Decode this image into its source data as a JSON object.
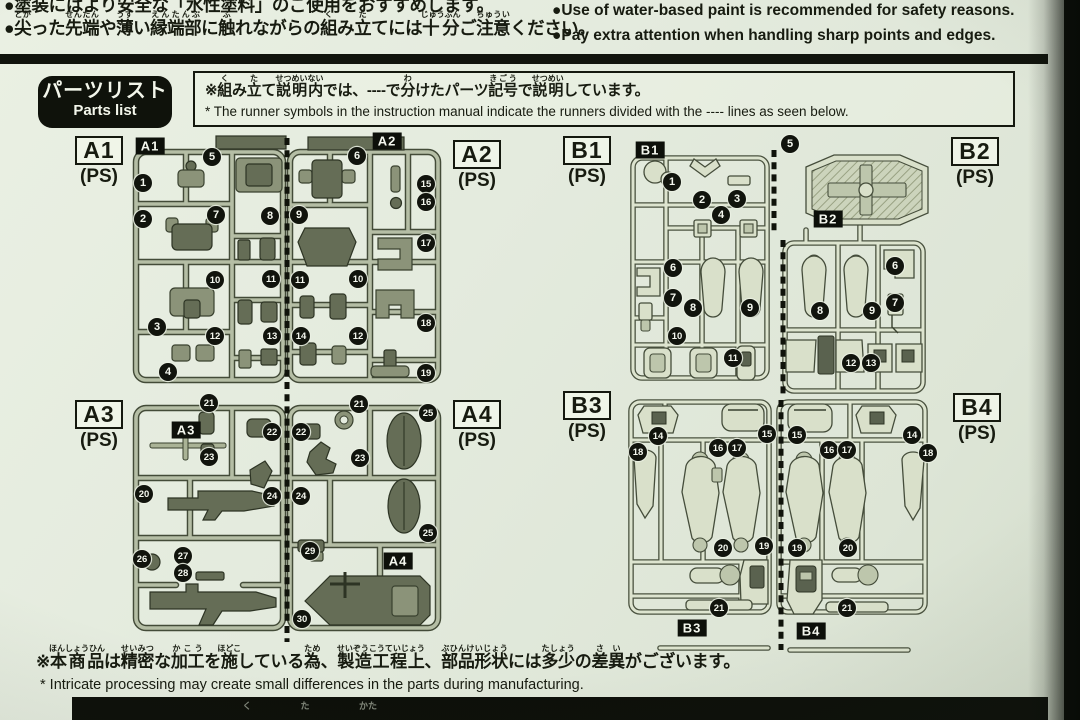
{
  "safety_notes": {
    "jp1": "●塗装にはより安全な「水性塗料」のご使用をおすすめします。",
    "jp2": [
      [
        "●"
      ],
      [
        "尖",
        "とが"
      ],
      [
        "った"
      ],
      [
        "先端",
        "せんたん"
      ],
      [
        "や"
      ],
      [
        "薄",
        "うす"
      ],
      [
        "い"
      ],
      [
        "縁端部",
        "えんたんぶ"
      ],
      [
        "に"
      ],
      [
        "触",
        "ふ"
      ],
      [
        "れながらの"
      ],
      [
        "組",
        "く"
      ],
      [
        "み"
      ],
      [
        "立",
        "た"
      ],
      [
        "てには"
      ],
      [
        "十分",
        "じゅうぶん"
      ],
      [
        "ご"
      ],
      [
        "注意",
        "ちゅうい"
      ],
      [
        "ください。"
      ]
    ],
    "en1": "●Use of water-based paint is recommended for safety reasons.",
    "en2": "●Pay extra attention when handling sharp points and edges."
  },
  "parts_list": {
    "title_jp": "パーツリスト",
    "title_en": "Parts list"
  },
  "runner_note": {
    "jp": [
      [
        "※"
      ],
      [
        "組",
        "く"
      ],
      [
        "み"
      ],
      [
        "立",
        "た"
      ],
      [
        "て"
      ],
      [
        "説明内",
        "せつめいない"
      ],
      [
        "では、----で"
      ],
      [
        "分",
        "わ"
      ],
      [
        "けたパーツ"
      ],
      [
        "記号",
        "きごう"
      ],
      [
        "で"
      ],
      [
        "説明",
        "せつめい"
      ],
      [
        "しています。"
      ]
    ],
    "en": "* The runner symbols in the instruction manual indicate the runners divided with the ---- lines as seen below."
  },
  "bottom_note": {
    "jp": [
      [
        "※"
      ],
      [
        "本商品",
        "ほんしょうひん"
      ],
      [
        "は"
      ],
      [
        "精密",
        "せいみつ"
      ],
      [
        "な"
      ],
      [
        "加工",
        "かこう"
      ],
      [
        "を"
      ],
      [
        "施",
        "ほどこ"
      ],
      [
        "している"
      ],
      [
        "為",
        "ため"
      ],
      [
        "、"
      ],
      [
        "製造工程上",
        "せいぞうこうていじょう"
      ],
      [
        "、"
      ],
      [
        "部品形状",
        "ぶひんけいじょう"
      ],
      [
        "には"
      ],
      [
        "多少",
        "たしょう"
      ],
      [
        "の"
      ],
      [
        "差異",
        "さい"
      ],
      [
        "がございます。"
      ]
    ],
    "en": "* Intricate processing may create small differences in the parts during manufacturing."
  },
  "next_section": {
    "furigana": [
      {
        "t": "く",
        "x": 247
      },
      {
        "t": "た",
        "x": 305
      },
      {
        "t": "かた",
        "x": 368
      }
    ]
  },
  "colors": {
    "page": "#e4ebde",
    "ink": "#171b10",
    "black": "#0d100a"
  },
  "runners": [
    {
      "code": "A1",
      "material": "(PS)",
      "label": {
        "x": 68,
        "y": 136
      },
      "tag": {
        "x": 150,
        "y": 146
      },
      "parts": [
        {
          "n": "1",
          "x": 143,
          "y": 183
        },
        {
          "n": "2",
          "x": 143,
          "y": 219
        },
        {
          "n": "5",
          "x": 212,
          "y": 157
        },
        {
          "n": "7",
          "x": 216,
          "y": 215
        },
        {
          "n": "8",
          "x": 270,
          "y": 216
        },
        {
          "n": "10",
          "x": 215,
          "y": 280
        },
        {
          "n": "11",
          "x": 271,
          "y": 279
        },
        {
          "n": "3",
          "x": 157,
          "y": 327
        },
        {
          "n": "12",
          "x": 215,
          "y": 336
        },
        {
          "n": "13",
          "x": 272,
          "y": 336
        },
        {
          "n": "4",
          "x": 168,
          "y": 372
        }
      ]
    },
    {
      "code": "A2",
      "material": "(PS)",
      "label": {
        "x": 446,
        "y": 140
      },
      "tag": {
        "x": 387,
        "y": 141
      },
      "parts": [
        {
          "n": "6",
          "x": 357,
          "y": 156
        },
        {
          "n": "9",
          "x": 299,
          "y": 215
        },
        {
          "n": "11",
          "x": 300,
          "y": 280
        },
        {
          "n": "10",
          "x": 358,
          "y": 279
        },
        {
          "n": "14",
          "x": 301,
          "y": 336
        },
        {
          "n": "12",
          "x": 358,
          "y": 336
        },
        {
          "n": "15",
          "x": 426,
          "y": 184
        },
        {
          "n": "16",
          "x": 426,
          "y": 202
        },
        {
          "n": "17",
          "x": 426,
          "y": 243
        },
        {
          "n": "18",
          "x": 426,
          "y": 323
        },
        {
          "n": "19",
          "x": 426,
          "y": 373
        }
      ]
    },
    {
      "code": "A3",
      "material": "(PS)",
      "label": {
        "x": 68,
        "y": 400
      },
      "tag": {
        "x": 186,
        "y": 430
      },
      "parts": [
        {
          "n": "21",
          "x": 209,
          "y": 403
        },
        {
          "n": "22",
          "x": 272,
          "y": 432
        },
        {
          "n": "23",
          "x": 209,
          "y": 457
        },
        {
          "n": "20",
          "x": 144,
          "y": 494
        },
        {
          "n": "24",
          "x": 272,
          "y": 496
        },
        {
          "n": "26",
          "x": 142,
          "y": 559
        },
        {
          "n": "27",
          "x": 183,
          "y": 556
        },
        {
          "n": "28",
          "x": 183,
          "y": 573
        }
      ]
    },
    {
      "code": "A4",
      "material": "(PS)",
      "label": {
        "x": 446,
        "y": 400
      },
      "tag": {
        "x": 398,
        "y": 561
      },
      "parts": [
        {
          "n": "22",
          "x": 301,
          "y": 432
        },
        {
          "n": "21",
          "x": 359,
          "y": 404
        },
        {
          "n": "23",
          "x": 360,
          "y": 458
        },
        {
          "n": "24",
          "x": 301,
          "y": 496
        },
        {
          "n": "25",
          "x": 428,
          "y": 413
        },
        {
          "n": "25",
          "x": 428,
          "y": 533
        },
        {
          "n": "29",
          "x": 310,
          "y": 551
        },
        {
          "n": "30",
          "x": 302,
          "y": 619
        }
      ]
    },
    {
      "code": "B1",
      "material": "(PS)",
      "label": {
        "x": 556,
        "y": 136
      },
      "tag": {
        "x": 650,
        "y": 150
      },
      "parts": [
        {
          "n": "1",
          "x": 672,
          "y": 182
        },
        {
          "n": "2",
          "x": 702,
          "y": 200
        },
        {
          "n": "3",
          "x": 737,
          "y": 199
        },
        {
          "n": "4",
          "x": 721,
          "y": 215
        },
        {
          "n": "6",
          "x": 673,
          "y": 268
        },
        {
          "n": "7",
          "x": 673,
          "y": 298
        },
        {
          "n": "8",
          "x": 693,
          "y": 308
        },
        {
          "n": "9",
          "x": 750,
          "y": 308
        },
        {
          "n": "10",
          "x": 677,
          "y": 336
        },
        {
          "n": "11",
          "x": 733,
          "y": 358
        }
      ]
    },
    {
      "code": "B2",
      "material": "(PS)",
      "label": {
        "x": 944,
        "y": 137
      },
      "tag": {
        "x": 828,
        "y": 219
      },
      "parts": [
        {
          "n": "5",
          "x": 790,
          "y": 144
        },
        {
          "n": "6",
          "x": 895,
          "y": 266
        },
        {
          "n": "7",
          "x": 895,
          "y": 303
        },
        {
          "n": "8",
          "x": 820,
          "y": 311
        },
        {
          "n": "9",
          "x": 872,
          "y": 311
        },
        {
          "n": "12",
          "x": 851,
          "y": 363
        },
        {
          "n": "13",
          "x": 871,
          "y": 363
        }
      ]
    },
    {
      "code": "B3",
      "material": "(PS)",
      "label": {
        "x": 556,
        "y": 391
      },
      "tag": {
        "x": 692,
        "y": 628
      },
      "parts": [
        {
          "n": "14",
          "x": 658,
          "y": 436
        },
        {
          "n": "15",
          "x": 767,
          "y": 434
        },
        {
          "n": "16",
          "x": 718,
          "y": 448
        },
        {
          "n": "17",
          "x": 737,
          "y": 448
        },
        {
          "n": "18",
          "x": 638,
          "y": 452
        },
        {
          "n": "20",
          "x": 723,
          "y": 548
        },
        {
          "n": "19",
          "x": 764,
          "y": 546
        },
        {
          "n": "21",
          "x": 719,
          "y": 608
        }
      ]
    },
    {
      "code": "B4",
      "material": "(PS)",
      "label": {
        "x": 946,
        "y": 393
      },
      "tag": {
        "x": 811,
        "y": 631
      },
      "parts": [
        {
          "n": "15",
          "x": 797,
          "y": 435
        },
        {
          "n": "14",
          "x": 912,
          "y": 435
        },
        {
          "n": "16",
          "x": 829,
          "y": 450
        },
        {
          "n": "17",
          "x": 847,
          "y": 450
        },
        {
          "n": "18",
          "x": 928,
          "y": 453
        },
        {
          "n": "19",
          "x": 797,
          "y": 548
        },
        {
          "n": "20",
          "x": 848,
          "y": 548
        },
        {
          "n": "21",
          "x": 847,
          "y": 608
        }
      ]
    }
  ]
}
